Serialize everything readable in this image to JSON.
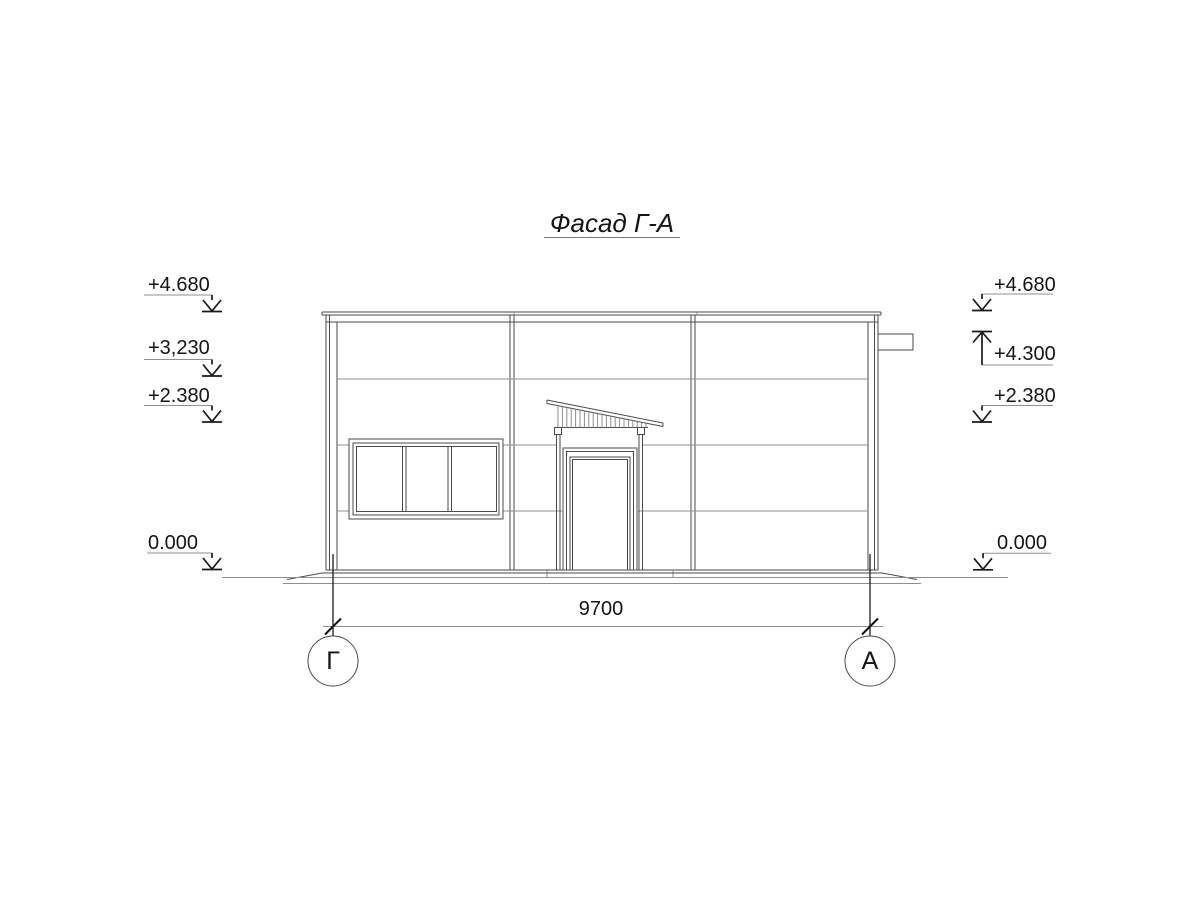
{
  "drawing": {
    "title": "Фасад Г-А",
    "levels_left": [
      {
        "label": "+4.680"
      },
      {
        "label": "+3,230"
      },
      {
        "label": "+2.380"
      },
      {
        "label": "0.000"
      }
    ],
    "levels_right": [
      {
        "label": "+4.680"
      },
      {
        "label": "+4.300"
      },
      {
        "label": "+2.380"
      },
      {
        "label": "0.000"
      }
    ],
    "dimension": {
      "length": "9700"
    },
    "axes": {
      "left": "Г",
      "right": "А"
    },
    "colors": {
      "line_main": "#4a4a4a",
      "line_light": "#8f8f8f",
      "line_dark": "#1c1c1c",
      "text": "#141414",
      "background": "#ffffff"
    }
  }
}
